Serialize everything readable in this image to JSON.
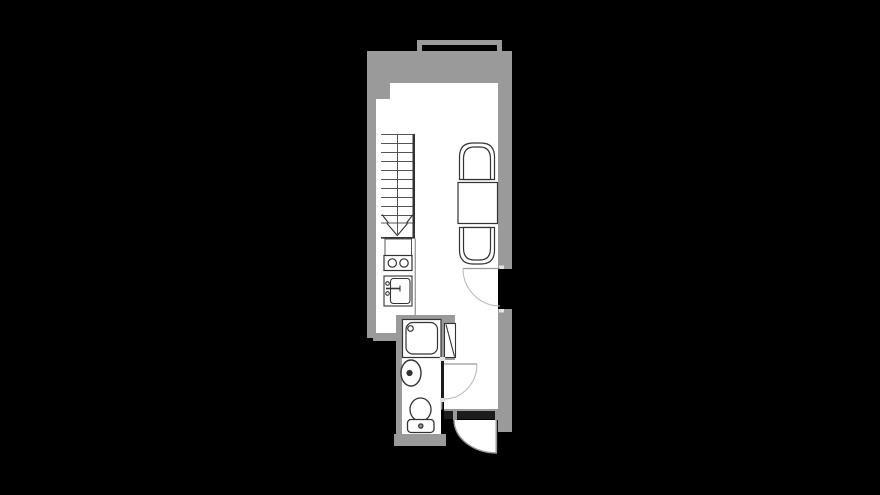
{
  "colors": {
    "background": "#000000",
    "wall": "#9a9a9a",
    "floor": "#ffffff",
    "fixture_line": "#333333",
    "stair_line": "#555555",
    "thin_wall_line": "#999999",
    "door_arc": "#bbbbbb",
    "door_leaf": "#9a9a9a",
    "jamb_tick": "#e2e2e2",
    "dark_bar": "#1c1c1c",
    "counter_line": "#999999"
  },
  "plan": {
    "type": "studio-apartment-floor-plan",
    "staircase": {
      "tread_lines": 10,
      "arrow_direction": "down"
    },
    "kitchen_stove_burners": 2,
    "dining_chairs": 2,
    "fixtures": [
      "balcony-railing",
      "sliding-window",
      "staircase",
      "kitchen-stove",
      "kitchen-sink",
      "kitchen-counter",
      "dining-table",
      "dining-chair-top",
      "dining-chair-bottom",
      "shower-unit",
      "washbasin",
      "toilet",
      "bathroom-door",
      "right-wall-door",
      "entrance-door"
    ]
  }
}
